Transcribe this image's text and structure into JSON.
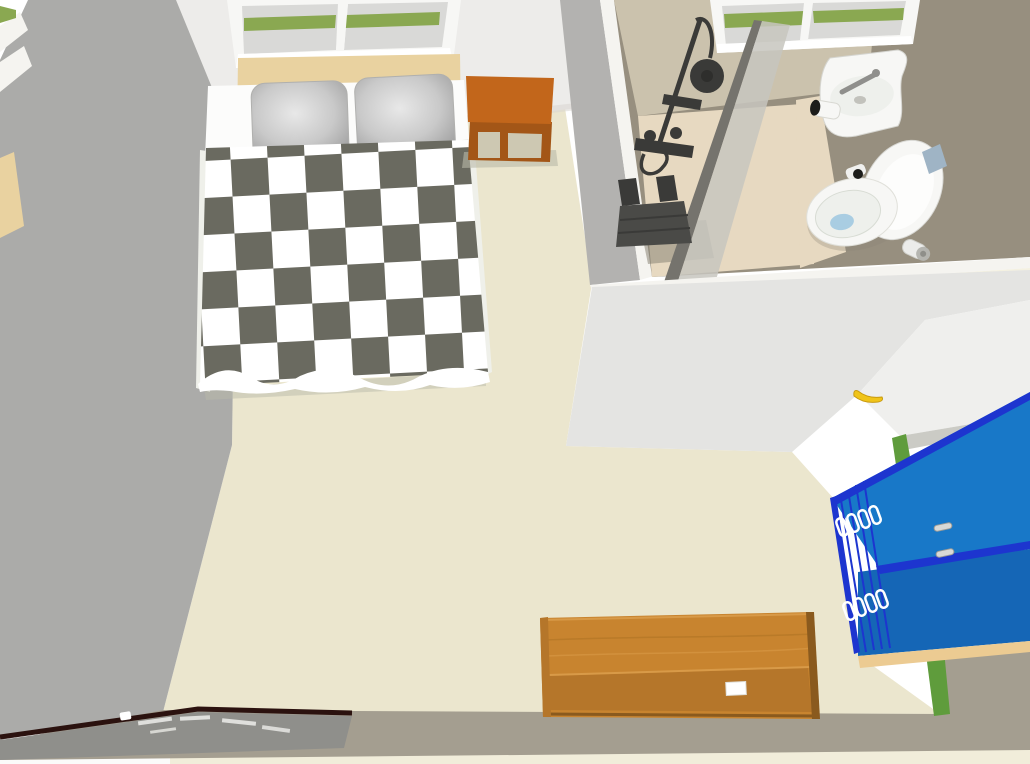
{
  "scene": {
    "view": "3d-overhead-room-render",
    "rooms": {
      "bedroom": "bedroom with double bed",
      "bathroom": "en-suite bathroom with shower, sink and toilet"
    },
    "objects": {
      "bed": "double bed with checkered duvet",
      "pillows": "two gray pillows",
      "headboard": "light wood headboard",
      "nightstand": "orange bedside table",
      "bedroom_window": "white double window with grass view",
      "bathroom_window": "white double window with grass view",
      "shower": "black shower column with rain head and mixer",
      "shower_seat": "dark fold-down shower seat",
      "shower_glass": "glass shower panel",
      "sink": "white wall-hung basin with chrome faucet",
      "toilet": "white toilet with open lid",
      "toilet_paper": "toilet paper roll holders",
      "cabinet": "blue double cabinet with silver handles",
      "desk": "wooden desk",
      "desk_paper": "white paper sheet on desk",
      "keyboard_piano": "dark keyboard instrument at bottom edge",
      "banana": "yellow banana on white table",
      "table": "white table surface",
      "grass": "grass visible between walls"
    }
  },
  "colors": {
    "page_bg": "#ffffff",
    "outside_cream": "#f1edda",
    "outside_white": "#fbfbfa",
    "floor_cream": "#ebe6ce",
    "wall_gray": "#ababa9",
    "wall_white": "#edecea",
    "wall_shadow": "#d8d6d0",
    "divider_gray": "#b3b2b0",
    "edge_white": "#f5f4f0",
    "window_frame": "#f7f7f5",
    "window_glass": "#d9d9d7",
    "glass_pane_green": "#8aa851",
    "headboard_wood": "#e9d2a0",
    "headboard_edge": "#d3ab6a",
    "sheet_white": "#fcfcfb",
    "mattress_edge": "#eff0ea",
    "duvet_dark": "#6a6a60",
    "duvet_white": "#ffffff",
    "bed_shadow": "#b9b9a9",
    "pillow_light": "#e6e6e6",
    "pillow_mid": "#c6c6c6",
    "pillow_dark": "#9e9e9e",
    "nightstand_top": "#c2661b",
    "nightstand_front": "#a35617",
    "nightstand_gap": "#cdc8b2",
    "bathroom_taupe": "#978f7f",
    "bathroom_wall_light": "#cbc2ad",
    "bathroom_floor": "#e7d9c1",
    "floor_shadow": "#8a8576",
    "glass_edge": "#75736d",
    "glass_face": "#c7c5be",
    "fixture_dark": "#3a3a38",
    "fixture_darker": "#2e2e2c",
    "seat_gray": "#4a4a47",
    "porcelain": "#f7f7f5",
    "porcelain_inner": "#eef0ec",
    "porcelain_stroke": "#d8d8d4",
    "water_blue": "#a9cde2",
    "tag_blue": "#9fb4c5",
    "chrome": "#8f8f8c",
    "black_detail": "#1c1c1a",
    "adjacent_gray": "#e4e4e2",
    "table_white": "#efefed",
    "table_edge": "#cbcbc5",
    "banana_yellow": "#f0c419",
    "banana_edge": "#c89a10",
    "grass_dark": "#5f9c3c",
    "cabinet_blue": "#1878c8",
    "cabinet_blue_dark": "#1566b6",
    "cabinet_edge": "#1d35cf",
    "cabinet_base": "#eccb92",
    "handle_silver": "#d9d9d6",
    "bottom_gray": "#a49e90",
    "desk_top": "#c8842f",
    "desk_front": "#b5762a",
    "desk_dark": "#8a5a1e",
    "desk_grain_light": "#d89a48",
    "piano_edge": "#2b120f",
    "piano_top": "#8f8f8b",
    "paper_white": "#ffffff"
  }
}
